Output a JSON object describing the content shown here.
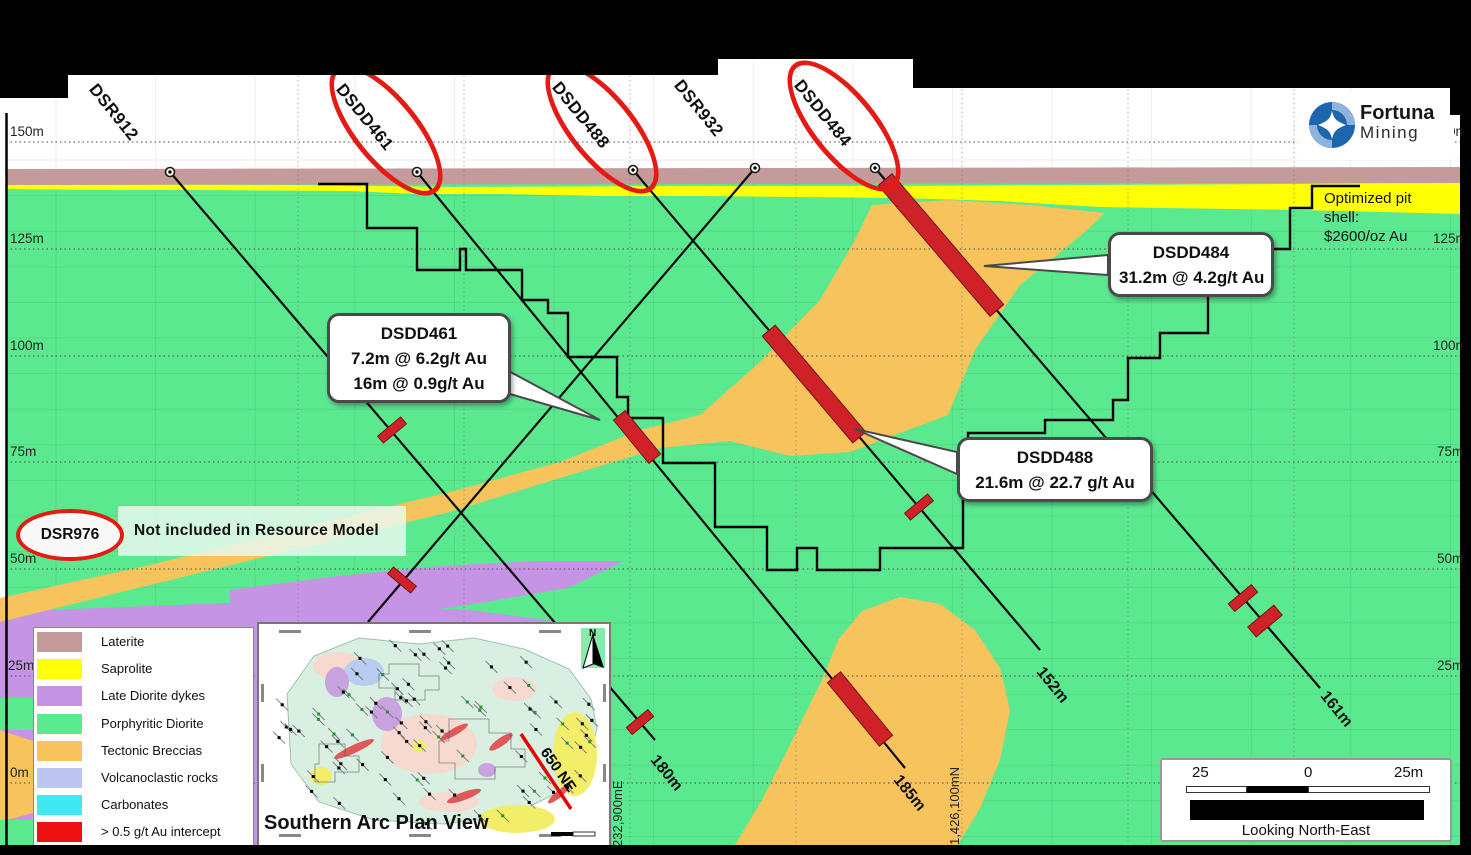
{
  "colors": {
    "laterite": "#c59a9a",
    "saprolite": "#ffff05",
    "dykes": "#c694e4",
    "diorite": "#5be990",
    "breccias": "#f6c35c",
    "volcanoclastic": "#bcc6f0",
    "carbonates": "#3fe9f2",
    "intercept": "#cf2128",
    "legend_red": "#ee1111",
    "ellipse_red": "#e41b14",
    "inset_teal": "#d8efe2",
    "logo_blue": "#1b66ad",
    "logo_blue_light": "#8fb3dc"
  },
  "drill_holes": [
    {
      "id": "DSR912",
      "end_depth": "180m"
    },
    {
      "id": "DSDD461",
      "end_depth": "185m"
    },
    {
      "id": "DSDD488",
      "end_depth": "152m"
    },
    {
      "id": "DSR932"
    },
    {
      "id": "DSDD484",
      "end_depth": "161m"
    }
  ],
  "callouts": [
    {
      "title": "DSDD461",
      "line1": "7.2m @ 6.2g/t Au",
      "line2": "16m @ 0.9g/t Au"
    },
    {
      "title": "DSDD488",
      "line1": "21.6m @ 22.7 g/t Au"
    },
    {
      "title": "DSDD484",
      "line1": "31.2m @ 4.2g/t Au"
    }
  ],
  "pit_label": {
    "line1": "Optimized  pit",
    "line2": "shell:",
    "line3": "$2600/oz  Au"
  },
  "note": {
    "hole": "DSR976",
    "text": "Not included  in Resource Model"
  },
  "elevation_left": [
    "150m",
    "125m",
    "100m",
    "75m",
    "50m",
    "25m",
    "0m"
  ],
  "elevation_right": [
    "150m",
    "125m",
    "100m",
    "75m",
    "50m",
    "25m"
  ],
  "coords": {
    "easting": "232,900mE",
    "northing": "1,426,100mN"
  },
  "legend": {
    "items": [
      {
        "label": "Laterite",
        "color": "#c59a9a"
      },
      {
        "label": "Saprolite",
        "color": "#ffff05"
      },
      {
        "label": "Late Diorite dykes",
        "color": "#c694e4"
      },
      {
        "label": "Porphyritic Diorite",
        "color": "#5be990"
      },
      {
        "label": "Tectonic Breccias",
        "color": "#f6c35c"
      },
      {
        "label": "Volcanoclastic rocks",
        "color": "#bcc6f0"
      },
      {
        "label": "Carbonates",
        "color": "#3fe9f2"
      },
      {
        "label": "> 0.5 g/t Au intercept",
        "color": "#ee1111"
      }
    ]
  },
  "inset": {
    "title": "Southern Arc Plan View",
    "section_label": "650  NE",
    "north": "N"
  },
  "scalebar": {
    "left": "25",
    "mid": "0",
    "right": "25m",
    "caption": "Looking North-East"
  },
  "logo": {
    "name": "Fortuna",
    "sub": "Mining"
  }
}
